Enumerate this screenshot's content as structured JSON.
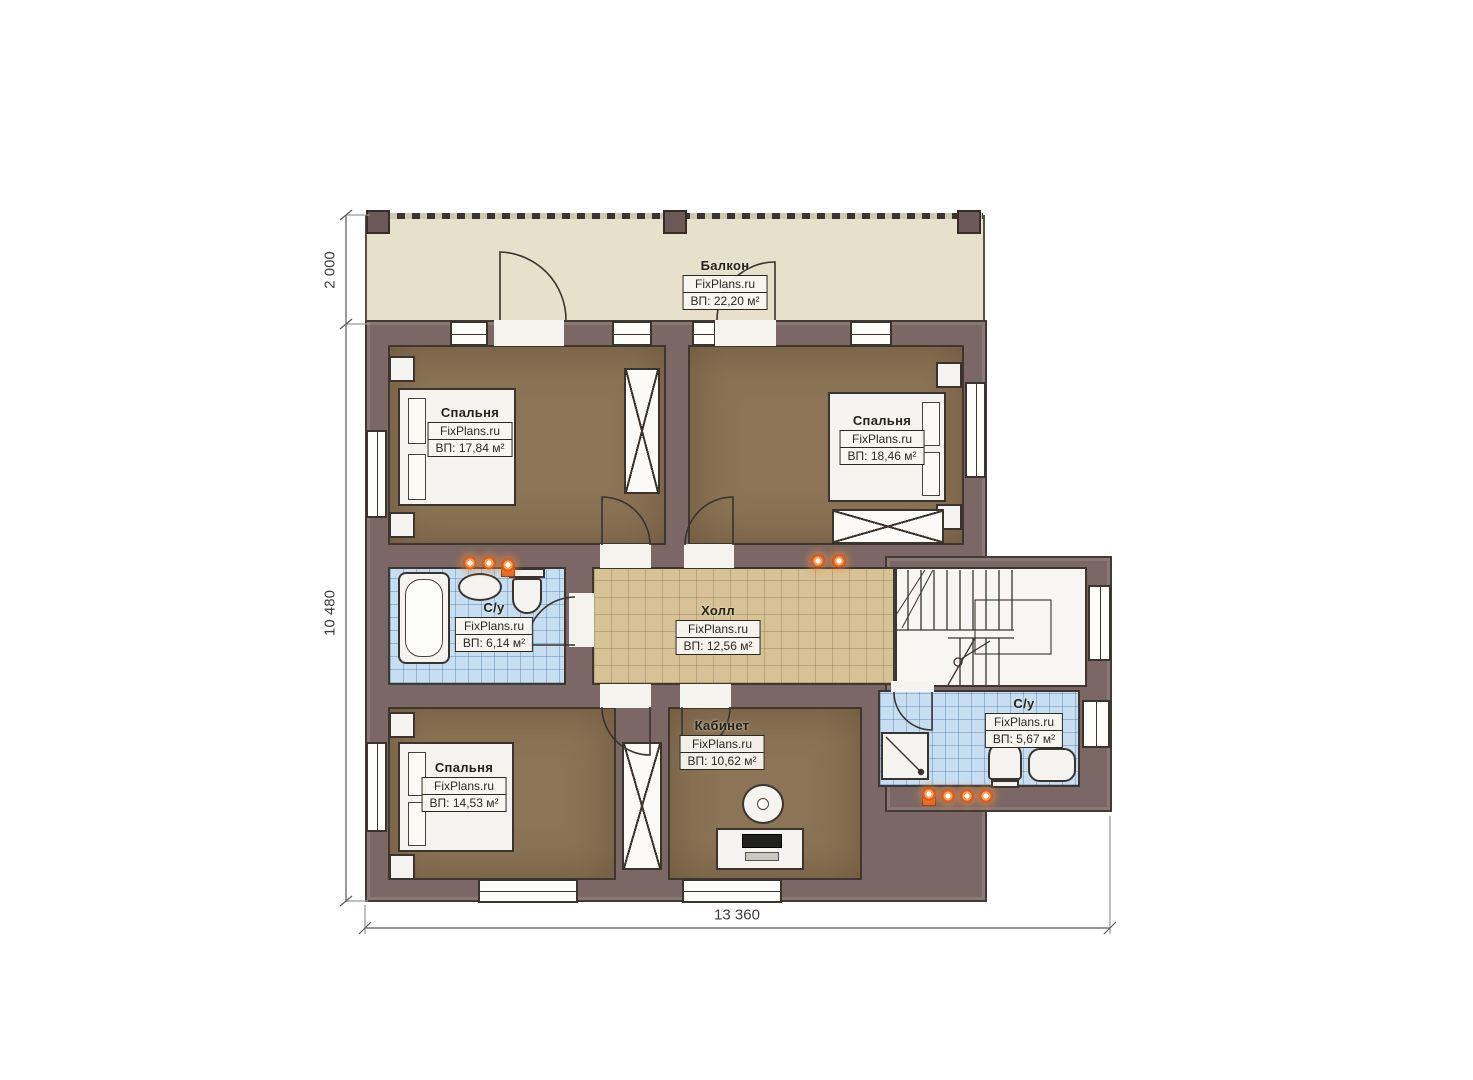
{
  "brand": "FixPlans.ru",
  "plan_title": "Floor plan — second storey",
  "rooms": {
    "balcony": {
      "name": "Балкон",
      "area": "ВП: 22,20 м²"
    },
    "bedroom_tl": {
      "name": "Спальня",
      "area": "ВП: 17,84 м²"
    },
    "bedroom_tr": {
      "name": "Спальня",
      "area": "ВП: 18,46 м²"
    },
    "bathroom_left": {
      "name": "С/у",
      "area": "ВП: 6,14 м²"
    },
    "hall": {
      "name": "Холл",
      "area": "ВП: 12,56 м²"
    },
    "bedroom_bl": {
      "name": "Спальня",
      "area": "ВП: 14,53 м²"
    },
    "office": {
      "name": "Кабинет",
      "area": "ВП: 10,62 м²"
    },
    "bathroom_right": {
      "name": "С/у",
      "area": "ВП: 5,67 м²"
    }
  },
  "dimensions": {
    "balcony_depth": "2 000",
    "building_depth": "10 480",
    "building_width": "13 360"
  },
  "colors": {
    "wall": "#7b6864",
    "floor_wood": "#8c7456",
    "floor_hall": "#d5c295",
    "floor_bath": "#c6def2",
    "floor_balcony": "#e7e0cb",
    "spotlight": "#e25c1d"
  }
}
